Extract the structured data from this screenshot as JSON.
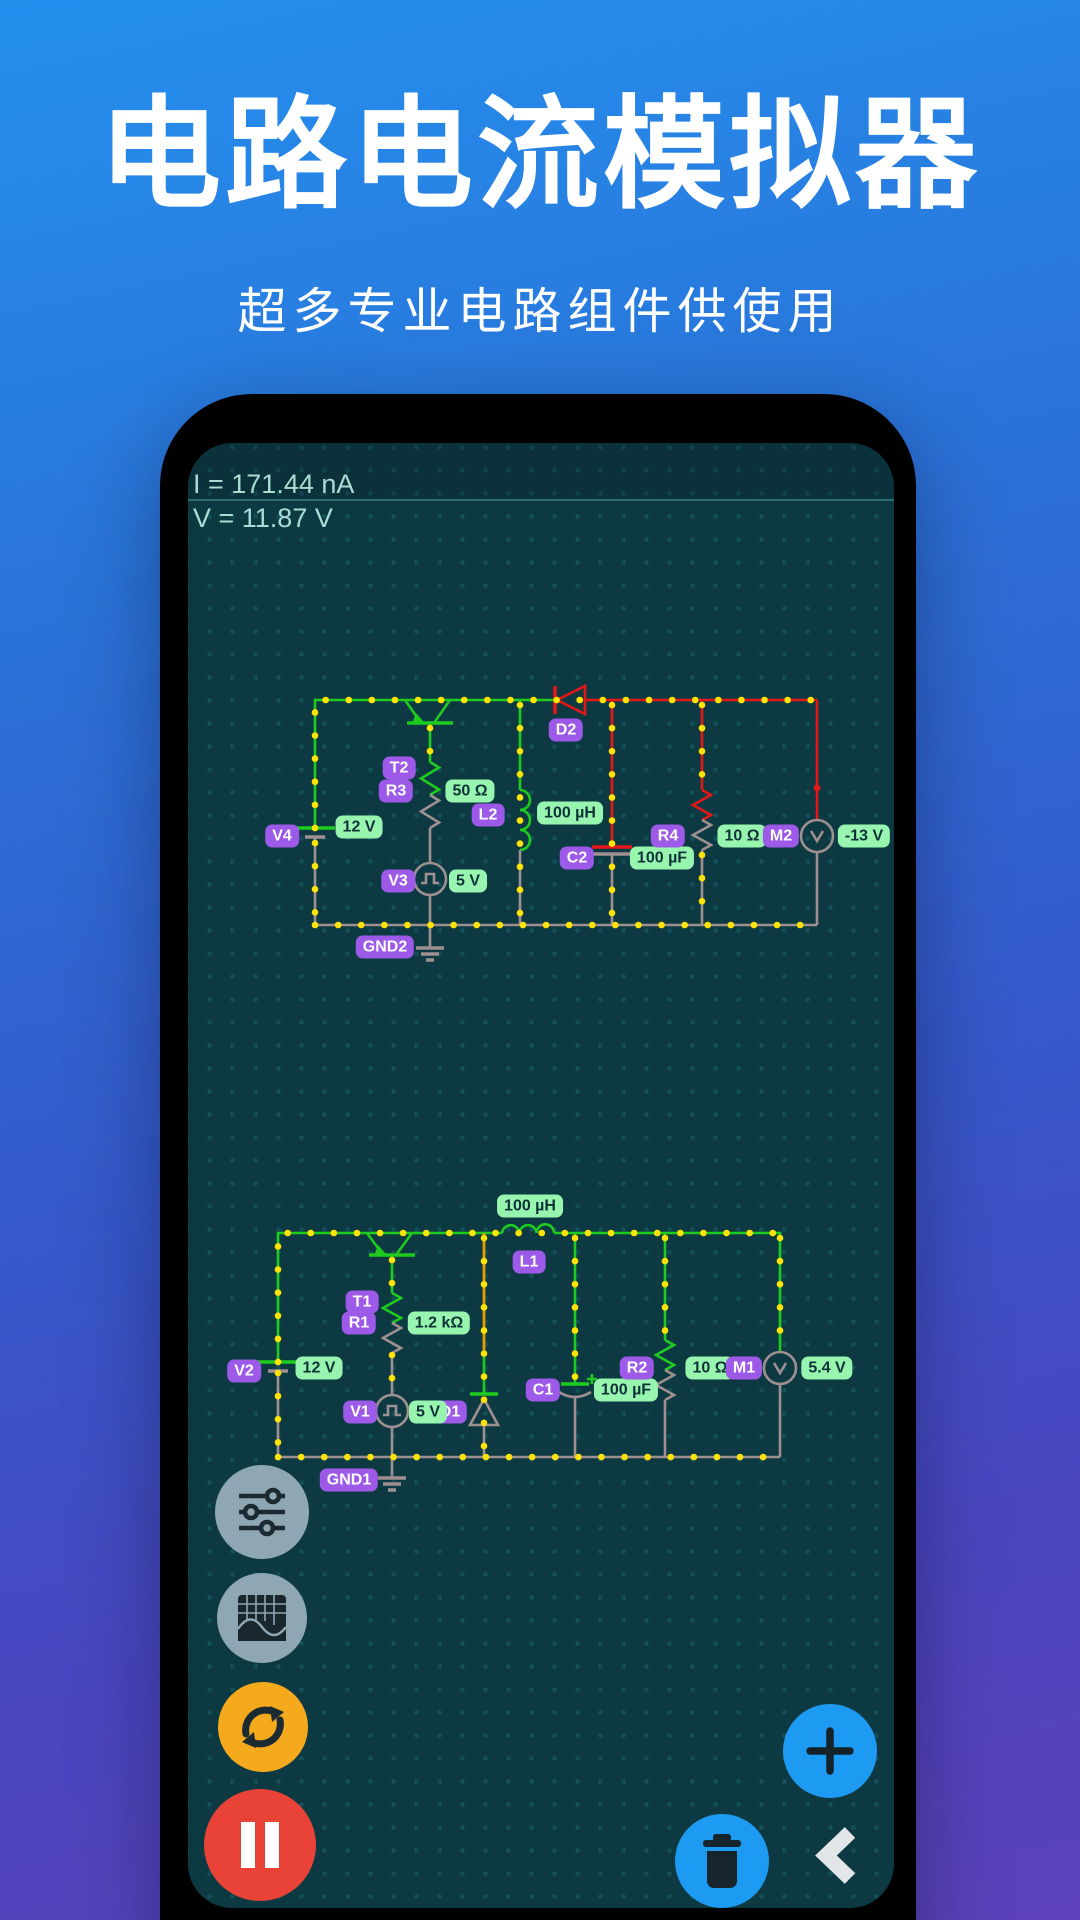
{
  "header": {
    "title": "电路电流模拟器",
    "subtitle": "超多专业电路组件供使用"
  },
  "simulator": {
    "status": {
      "current": "I = 171.44 nA",
      "voltage": "V = 11.87 V"
    },
    "badges": [
      {
        "id": "v4",
        "text": "V4",
        "kind": "purple",
        "x": 94,
        "y": 393
      },
      {
        "id": "v4-value",
        "text": "12 V",
        "kind": "green",
        "x": 171,
        "y": 384
      },
      {
        "id": "t2",
        "text": "T2",
        "kind": "purple",
        "x": 211,
        "y": 325
      },
      {
        "id": "r3",
        "text": "R3",
        "kind": "purple",
        "x": 208,
        "y": 348
      },
      {
        "id": "r3-value",
        "text": "50 Ω",
        "kind": "green",
        "x": 282,
        "y": 348
      },
      {
        "id": "l2",
        "text": "L2",
        "kind": "purple",
        "x": 300,
        "y": 372
      },
      {
        "id": "l2-value",
        "text": "100 µH",
        "kind": "green",
        "x": 382,
        "y": 370
      },
      {
        "id": "d2",
        "text": "D2",
        "kind": "purple",
        "x": 378,
        "y": 287
      },
      {
        "id": "v3",
        "text": "V3",
        "kind": "purple",
        "x": 210,
        "y": 438
      },
      {
        "id": "v3-value",
        "text": "5 V",
        "kind": "green",
        "x": 280,
        "y": 438
      },
      {
        "id": "c2",
        "text": "C2",
        "kind": "purple",
        "x": 389,
        "y": 415
      },
      {
        "id": "c2-value",
        "text": "100 µF",
        "kind": "green",
        "x": 474,
        "y": 415
      },
      {
        "id": "r4",
        "text": "R4",
        "kind": "purple",
        "x": 480,
        "y": 393
      },
      {
        "id": "r4-value",
        "text": "10 Ω",
        "kind": "green",
        "x": 554,
        "y": 393
      },
      {
        "id": "m2",
        "text": "M2",
        "kind": "purple",
        "x": 593,
        "y": 393
      },
      {
        "id": "m2-value",
        "text": "-13 V",
        "kind": "green",
        "x": 676,
        "y": 393
      },
      {
        "id": "gnd2",
        "text": "GND2",
        "kind": "purple",
        "x": 197,
        "y": 504
      },
      {
        "id": "l1-value",
        "text": "100 µH",
        "kind": "green",
        "x": 342,
        "y": 763
      },
      {
        "id": "l1",
        "text": "L1",
        "kind": "purple",
        "x": 341,
        "y": 819
      },
      {
        "id": "t1",
        "text": "T1",
        "kind": "purple",
        "x": 174,
        "y": 859
      },
      {
        "id": "r1",
        "text": "R1",
        "kind": "purple",
        "x": 171,
        "y": 880
      },
      {
        "id": "r1-value",
        "text": "1.2 kΩ",
        "kind": "green",
        "x": 251,
        "y": 880
      },
      {
        "id": "v2",
        "text": "V2",
        "kind": "purple",
        "x": 56,
        "y": 928
      },
      {
        "id": "v2-value",
        "text": "12 V",
        "kind": "green",
        "x": 131,
        "y": 925
      },
      {
        "id": "v1",
        "text": "V1",
        "kind": "purple",
        "x": 172,
        "y": 969
      },
      {
        "id": "d1",
        "text": "D1",
        "kind": "purple",
        "x": 262,
        "y": 969
      },
      {
        "id": "v1-value",
        "text": "5 V",
        "kind": "green",
        "x": 240,
        "y": 969
      },
      {
        "id": "c1",
        "text": "C1",
        "kind": "purple",
        "x": 355,
        "y": 947
      },
      {
        "id": "c1-value",
        "text": "100 µF",
        "kind": "green",
        "x": 438,
        "y": 947
      },
      {
        "id": "r2",
        "text": "R2",
        "kind": "purple",
        "x": 449,
        "y": 925
      },
      {
        "id": "r2-value",
        "text": "10 Ω",
        "kind": "green",
        "x": 522,
        "y": 925
      },
      {
        "id": "m1",
        "text": "M1",
        "kind": "purple",
        "x": 556,
        "y": 925
      },
      {
        "id": "m1-value",
        "text": "5.4 V",
        "kind": "green",
        "x": 639,
        "y": 925
      },
      {
        "id": "gnd1",
        "text": "GND1",
        "kind": "purple",
        "x": 161,
        "y": 1037
      }
    ],
    "icons": {
      "settings": "sliders-icon",
      "oscilloscope": "waveform-grid-icon",
      "restart": "sync-arrows-icon",
      "pause": "pause-icon",
      "add": "plus-icon",
      "delete": "trash-icon",
      "back": "chevron-left-icon"
    },
    "colors": {
      "screen_bg": "#0d3a42",
      "wire_green": "#1ecb1e",
      "wire_red": "#e41717",
      "wire_orange": "#e89d00",
      "wire_gray": "#9e9090",
      "node_dot": "#ffe206",
      "badge_purple": "#9d5ae8",
      "badge_green": "#98f5b0",
      "fab_gray": "#8ea7b3",
      "fab_orange": "#f5a91c",
      "fab_red": "#e94338",
      "fab_blue": "#1d9bf3"
    }
  }
}
